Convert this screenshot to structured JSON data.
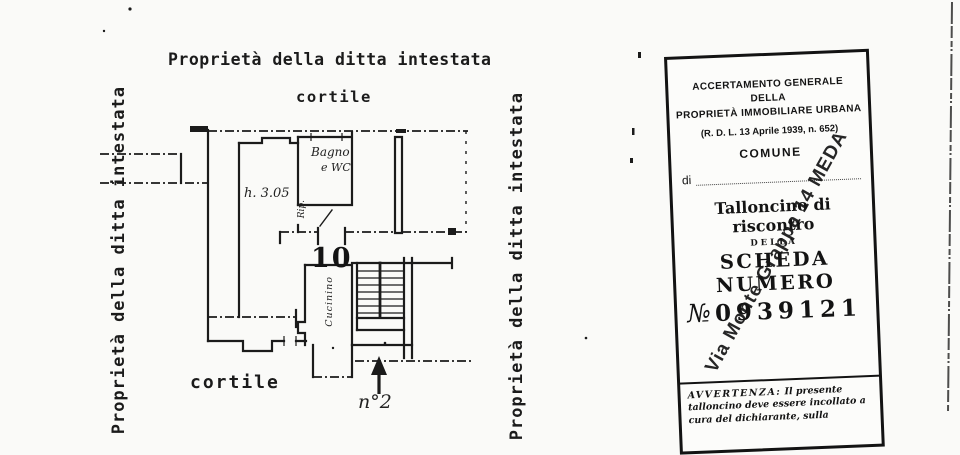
{
  "document": {
    "title": "Proprietà della ditta intestata",
    "side_label_left": "Proprietà della ditta intestata",
    "side_label_right": "Proprietà della ditta intestata"
  },
  "floor_plan": {
    "courtyard_label_top": "cortile",
    "courtyard_label_bottom": "cortile",
    "room_height_note": "h. 3.05",
    "bathroom_label_line1": "Bagno",
    "bathroom_label_line2": "e WC",
    "closet_label": "Rip.",
    "unit_number": "10",
    "kitchenette_label": "Cucinino",
    "street_entrance_label": "n°2"
  },
  "stamp_card": {
    "header_line1": "ACCERTAMENTO GENERALE DELLA",
    "header_line2": "PROPRIETÀ IMMOBILIARE URBANA",
    "law_reference": "(R. D. L. 13 Aprile 1939, n. 652)",
    "comune_label": "COMUNE",
    "di_label": "di",
    "slip_title": "Talloncino di riscontro",
    "della_label": "DELLA",
    "scheda_label": "SCHEDA NUMERO",
    "numero_symbol": "№",
    "serial_number": "0939121",
    "overstamp_text": "Via Monte Grappa 14 MEDA",
    "notice_label": "AVVERTENZA:",
    "notice_body": "Il presente talloncino deve essere incollato a cura del dichiarante, sulla"
  },
  "colors": {
    "ink": "#1b1b1b",
    "paper": "#fafaf8"
  }
}
